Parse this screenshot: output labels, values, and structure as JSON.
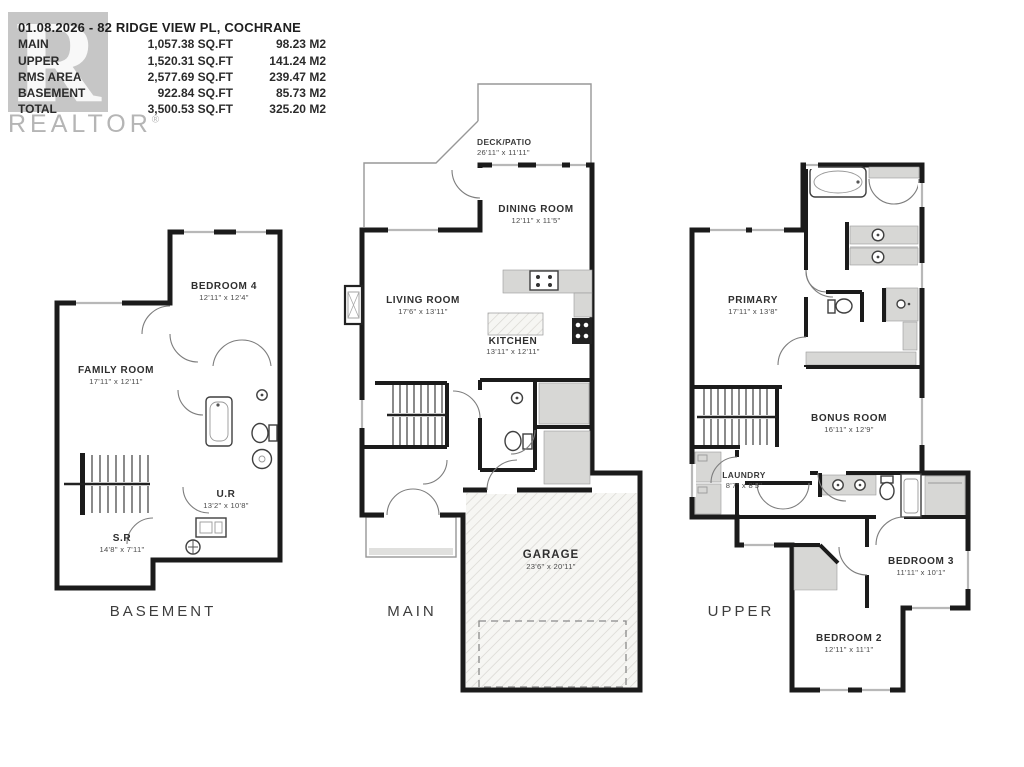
{
  "header": {
    "title": "01.08.2026 - 82 RIDGE VIEW PL, COCHRANE",
    "logo_letter": "R",
    "brand": "REALTOR",
    "brand_reg": "®",
    "area_table": {
      "rows": [
        {
          "label": "MAIN",
          "sqft": "1,057.38 SQ.FT",
          "m2": "98.23 M2"
        },
        {
          "label": "UPPER",
          "sqft": "1,520.31 SQ.FT",
          "m2": "141.24 M2"
        },
        {
          "label": "RMS AREA",
          "sqft": "2,577.69 SQ.FT",
          "m2": "239.47 M2"
        },
        {
          "label": "BASEMENT",
          "sqft": "922.84 SQ.FT",
          "m2": "85.73 M2"
        },
        {
          "label": "TOTAL",
          "sqft": "3,500.53 SQ.FT",
          "m2": "325.20 M2"
        }
      ]
    }
  },
  "floors": {
    "basement": {
      "label": "BASEMENT",
      "rooms": {
        "family": {
          "name": "FAMILY ROOM",
          "dims": "17'11\" x 12'11\""
        },
        "bedroom4": {
          "name": "BEDROOM 4",
          "dims": "12'11\" x 12'4\""
        },
        "ur": {
          "name": "U.R",
          "dims": "13'2\" x 10'8\""
        },
        "sr": {
          "name": "S.R",
          "dims": "14'8\" x 7'11\""
        }
      }
    },
    "main": {
      "label": "MAIN",
      "rooms": {
        "deck": {
          "name": "DECK/PATIO",
          "dims": "26'11\" x 11'11\""
        },
        "dining": {
          "name": "DINING ROOM",
          "dims": "12'11\" x 11'5\""
        },
        "living": {
          "name": "LIVING ROOM",
          "dims": "17'6\" x 13'11\""
        },
        "kitchen": {
          "name": "KITCHEN",
          "dims": "13'11\" x 12'11\""
        },
        "garage": {
          "name": "GARAGE",
          "dims": "23'6\" x 20'11\""
        }
      }
    },
    "upper": {
      "label": "UPPER",
      "rooms": {
        "primary": {
          "name": "PRIMARY",
          "dims": "17'11\" x 13'8\""
        },
        "bonus": {
          "name": "BONUS ROOM",
          "dims": "16'11\" x 12'9\""
        },
        "laundry": {
          "name": "LAUNDRY",
          "dims": "8'7\" x 8'5\""
        },
        "bedroom3": {
          "name": "BEDROOM 3",
          "dims": "11'11\" x 10'1\""
        },
        "bedroom2": {
          "name": "BEDROOM 2",
          "dims": "12'11\" x 11'1\""
        }
      }
    }
  },
  "colors": {
    "wall": "#1b1b1b",
    "logo_gray": "#c6c6c6",
    "brand_gray": "#b5b5b5"
  }
}
